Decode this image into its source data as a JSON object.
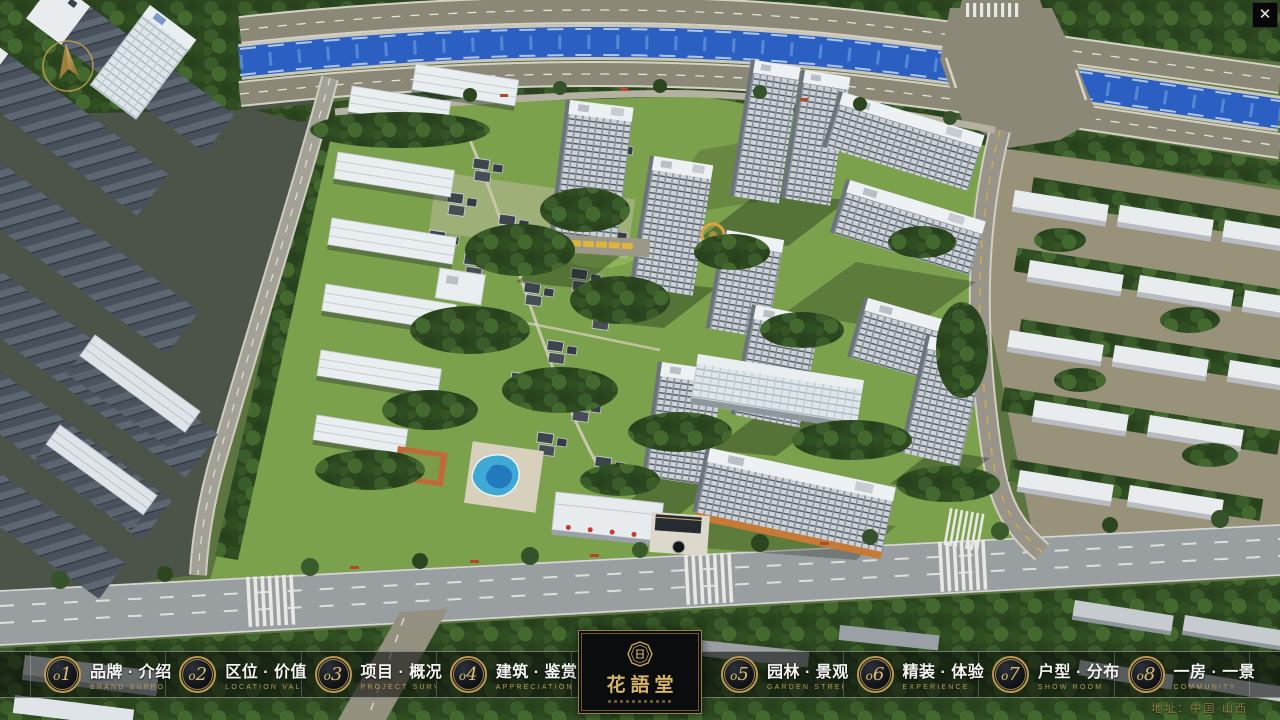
{
  "window": {
    "close_icon": "✕"
  },
  "nav": {
    "items_left": [
      {
        "num": "o1",
        "label": "品牌 · 介绍",
        "caption": "BRAND SUPPORT"
      },
      {
        "num": "o2",
        "label": "区位 · 价值",
        "caption": "LOCATION VALUE"
      },
      {
        "num": "o3",
        "label": "项目 · 概况",
        "caption": "PROJECT SURVEY"
      },
      {
        "num": "o4",
        "label": "建筑 · 鉴赏",
        "caption": "APPRECIATION"
      }
    ],
    "items_right": [
      {
        "num": "o5",
        "label": "园林 · 景观",
        "caption": "GARDEN STREET"
      },
      {
        "num": "o6",
        "label": "精装 · 体验",
        "caption": "EXPERIENCE"
      },
      {
        "num": "o7",
        "label": "户型 · 分布",
        "caption": "SHOW ROOM"
      },
      {
        "num": "o8",
        "label": "一房 · 一景",
        "caption": "COMMUNITY"
      }
    ],
    "logo": {
      "title": "花語堂"
    },
    "address": "地址：中国·山西"
  },
  "icons": {
    "compass": "compass-north-icon",
    "close": "close-icon",
    "seal": "brand-seal-icon"
  },
  "colors": {
    "accent_gold": "#c9a861",
    "caption_gold": "#b79a55",
    "label_white": "#f4f5f2",
    "bar_background": "rgba(10,12,10,0.58)",
    "river_blue": "#2c5fc2",
    "lawn_green": "#7ca14d",
    "road_gray": "#999ea0",
    "logo_background": "#0a0c0e"
  }
}
